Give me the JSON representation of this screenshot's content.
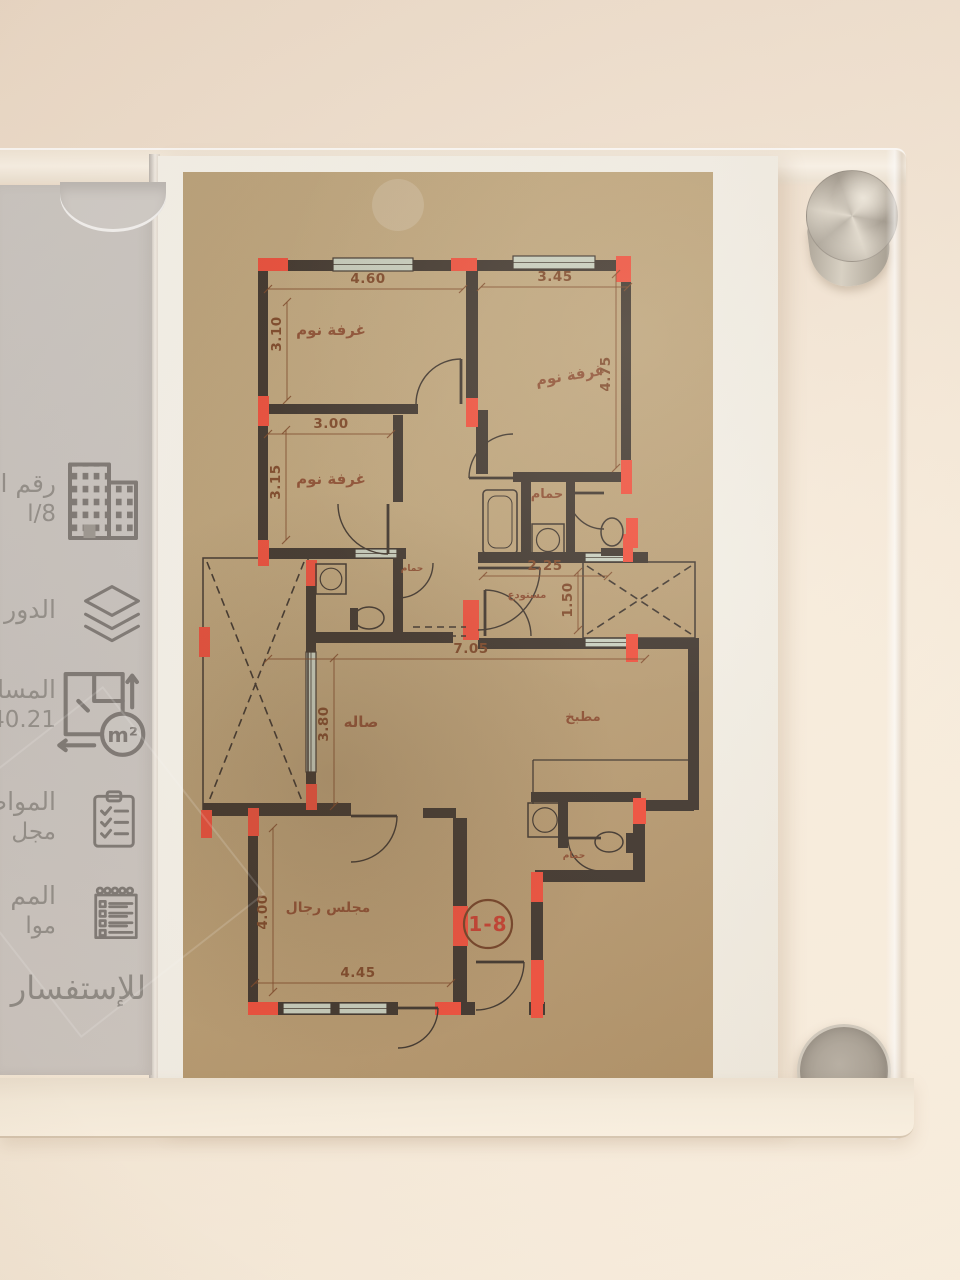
{
  "scene": {
    "description": "Photograph of an acrylic wall sign holding a Saudi apartment floor-plan sheet with a grey info strip"
  },
  "sidebar": {
    "items": [
      {
        "icon": "buildings-icon",
        "line1": "رقم ال",
        "line2": "ا/8"
      },
      {
        "icon": "layers-icon",
        "line1": "الدور",
        "line2": ""
      },
      {
        "icon": "area-icon",
        "line1": "المسا",
        "line2": "40.21",
        "icon_text": "m²"
      },
      {
        "icon": "clipboard-check-icon",
        "line1": "المواص",
        "line2": "مجل"
      },
      {
        "icon": "notes-icon",
        "line1": "المم",
        "line2": "موا"
      }
    ],
    "footer": "للإستفسار :"
  },
  "plan": {
    "unit_badge": {
      "x": 305,
      "y": 752,
      "r": 24,
      "t": "1-8"
    },
    "colors": {
      "line": "#3a3028",
      "red": "#ee4a37",
      "dimText": "#7b4424",
      "label": "#8a4a2d",
      "badgeText": "#c2392a",
      "badgeRing": "#6f3c20",
      "windowFill": "#c6cdbd"
    },
    "rooms": [
      {
        "t": "غرفة نوم",
        "x": 148,
        "y": 163,
        "s": 15,
        "rot": 0
      },
      {
        "t": "غرفة نوم",
        "x": 388,
        "y": 208,
        "s": 15,
        "rot": -9
      },
      {
        "t": "غرفة نوم",
        "x": 148,
        "y": 312,
        "s": 15,
        "rot": 0
      },
      {
        "t": "حمام",
        "x": 364,
        "y": 326,
        "s": 13,
        "rot": 0
      },
      {
        "t": "حمام",
        "x": 229,
        "y": 399,
        "s": 9,
        "rot": 0
      },
      {
        "t": "مستودع",
        "x": 344,
        "y": 426,
        "s": 10,
        "rot": 0
      },
      {
        "t": "صاله",
        "x": 178,
        "y": 555,
        "s": 15,
        "rot": 0
      },
      {
        "t": "مطبخ",
        "x": 400,
        "y": 549,
        "s": 13,
        "rot": 0
      },
      {
        "t": "حمام",
        "x": 391,
        "y": 686,
        "s": 9,
        "rot": 0
      },
      {
        "t": "مجلس رجال",
        "x": 145,
        "y": 740,
        "s": 14,
        "rot": 0
      }
    ],
    "dims": [
      {
        "t": "4.60",
        "x": 185,
        "y": 111,
        "rot": 0,
        "line": [
          85,
          117,
          280,
          117
        ]
      },
      {
        "t": "3.45",
        "x": 372,
        "y": 109,
        "rot": 0,
        "line": [
          298,
          115,
          445,
          115
        ]
      },
      {
        "t": "3.10",
        "x": 98,
        "y": 162,
        "rot": -90,
        "line": [
          104,
          130,
          104,
          228
        ]
      },
      {
        "t": "4.75",
        "x": 427,
        "y": 202,
        "rot": -90,
        "line": [
          433,
          102,
          433,
          296
        ]
      },
      {
        "t": "3.00",
        "x": 148,
        "y": 256,
        "rot": 0,
        "line": [
          85,
          262,
          208,
          262
        ]
      },
      {
        "t": "3.15",
        "x": 97,
        "y": 310,
        "rot": -90,
        "line": [
          103,
          258,
          103,
          368
        ]
      },
      {
        "t": "2.25",
        "x": 362,
        "y": 398,
        "rot": 0,
        "line": [
          300,
          404,
          425,
          404
        ]
      },
      {
        "t": "1.50",
        "x": 389,
        "y": 428,
        "rot": -90,
        "line": [
          395,
          400,
          395,
          458
        ]
      },
      {
        "t": "7.05",
        "x": 288,
        "y": 481,
        "rot": 0,
        "line": [
          85,
          487,
          462,
          487
        ]
      },
      {
        "t": "3.80",
        "x": 145,
        "y": 552,
        "rot": -90,
        "line": [
          151,
          486,
          151,
          634
        ]
      },
      {
        "t": "4.00",
        "x": 84,
        "y": 740,
        "rot": -90,
        "line": [
          90,
          656,
          90,
          820
        ]
      },
      {
        "t": "4.45",
        "x": 175,
        "y": 805,
        "rot": 0,
        "line": [
          72,
          811,
          268,
          811
        ]
      }
    ],
    "walls": [
      [
        75,
        88,
        373,
        11
      ],
      [
        75,
        88,
        10,
        155
      ],
      [
        75,
        232,
        160,
        10
      ],
      [
        283,
        99,
        12,
        156
      ],
      [
        438,
        88,
        10,
        232
      ],
      [
        330,
        300,
        118,
        10
      ],
      [
        338,
        300,
        10,
        88
      ],
      [
        383,
        308,
        9,
        75
      ],
      [
        295,
        380,
        170,
        11
      ],
      [
        75,
        243,
        10,
        140
      ],
      [
        75,
        376,
        148,
        11
      ],
      [
        210,
        243,
        10,
        87
      ],
      [
        293,
        238,
        12,
        64
      ],
      [
        210,
        383,
        10,
        88
      ],
      [
        130,
        460,
        140,
        11
      ],
      [
        123,
        388,
        10,
        250
      ],
      [
        295,
        466,
        172,
        11
      ],
      [
        460,
        466,
        55,
        11
      ],
      [
        505,
        466,
        11,
        172
      ],
      [
        450,
        628,
        61,
        11
      ],
      [
        450,
        628,
        12,
        82
      ],
      [
        348,
        620,
        110,
        10
      ],
      [
        375,
        628,
        10,
        48
      ],
      [
        352,
        698,
        110,
        12
      ],
      [
        348,
        700,
        12,
        135
      ],
      [
        20,
        631,
        148,
        13
      ],
      [
        240,
        636,
        33,
        10
      ],
      [
        65,
        640,
        10,
        202
      ],
      [
        270,
        646,
        14,
        190
      ],
      [
        65,
        830,
        150,
        13
      ],
      [
        252,
        830,
        40,
        13
      ],
      [
        346,
        830,
        16,
        13
      ]
    ],
    "windows": [
      [
        150,
        86,
        80,
        13
      ],
      [
        330,
        84,
        82,
        13
      ],
      [
        172,
        377,
        42,
        9
      ],
      [
        123,
        480,
        10,
        120
      ],
      [
        100,
        831,
        48,
        11
      ],
      [
        156,
        831,
        48,
        11
      ],
      [
        402,
        381,
        48,
        9
      ],
      [
        402,
        466,
        48,
        9
      ]
    ],
    "columns": [
      [
        75,
        86,
        30,
        13
      ],
      [
        268,
        86,
        26,
        13
      ],
      [
        433,
        84,
        15,
        26
      ],
      [
        75,
        224,
        11,
        30
      ],
      [
        283,
        226,
        12,
        29
      ],
      [
        438,
        288,
        11,
        34
      ],
      [
        440,
        362,
        10,
        28
      ],
      [
        75,
        368,
        11,
        26
      ],
      [
        16,
        455,
        11,
        30
      ],
      [
        18,
        638,
        11,
        28
      ],
      [
        123,
        388,
        11,
        26
      ],
      [
        123,
        612,
        11,
        26
      ],
      [
        280,
        428,
        16,
        40
      ],
      [
        443,
        346,
        12,
        30
      ],
      [
        443,
        462,
        12,
        28
      ],
      [
        450,
        626,
        13,
        26
      ],
      [
        348,
        700,
        12,
        30
      ],
      [
        348,
        788,
        13,
        44
      ],
      [
        270,
        734,
        15,
        40
      ],
      [
        65,
        830,
        30,
        13
      ],
      [
        252,
        830,
        26,
        13
      ],
      [
        65,
        636,
        11,
        28
      ],
      [
        348,
        822,
        12,
        24
      ]
    ],
    "shafts": [
      [
        20,
        386,
        105,
        252
      ],
      [
        400,
        390,
        112,
        76
      ]
    ],
    "doors": [
      [
        278,
        232,
        45,
        270,
        180
      ],
      [
        330,
        306,
        44,
        180,
        270
      ],
      [
        205,
        332,
        50,
        90,
        180
      ],
      [
        421,
        321,
        36,
        180,
        90
      ],
      [
        215,
        391,
        35,
        90,
        0
      ],
      [
        302,
        464,
        46,
        270,
        360
      ],
      [
        295,
        396,
        62,
        0,
        90
      ],
      [
        418,
        666,
        33,
        180,
        90
      ],
      [
        293,
        790,
        48,
        0,
        90
      ],
      [
        215,
        836,
        40,
        0,
        90
      ],
      [
        168,
        644,
        46,
        0,
        90
      ]
    ],
    "fixtures": {
      "tubs": [
        [
          300,
          318,
          34,
          64
        ]
      ],
      "sinks": [
        [
          349,
          352,
          32,
          32
        ],
        [
          133,
          392,
          30,
          30
        ],
        [
          345,
          631,
          34,
          34
        ]
      ],
      "toilets": [
        {
          "c": [
            429,
            360
          ],
          "rx": 11,
          "ry": 14,
          "tank": [
            418,
            376,
            22,
            8
          ]
        },
        {
          "c": [
            186,
            446
          ],
          "rx": 15,
          "ry": 11,
          "tank": [
            167,
            436,
            8,
            22
          ]
        },
        {
          "c": [
            426,
            670
          ],
          "rx": 14,
          "ry": 10,
          "tank": [
            443,
            661,
            8,
            20
          ]
        }
      ],
      "lines": [
        [
          [
            350,
            588
          ],
          [
            505,
            588
          ]
        ],
        [
          [
            350,
            588
          ],
          [
            350,
            632
          ]
        ]
      ],
      "dashed": [
        [
          [
            230,
            455
          ],
          [
            283,
            455
          ]
        ],
        [
          [
            230,
            464
          ],
          [
            283,
            464
          ]
        ]
      ]
    },
    "spot": {
      "x": 215,
      "y": 33,
      "r": 26
    }
  }
}
